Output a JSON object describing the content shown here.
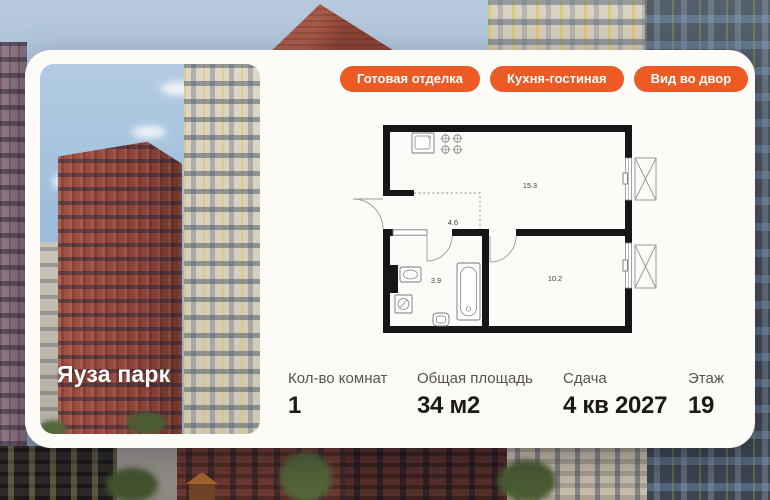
{
  "card": {
    "badges": [
      {
        "label": "Готовая отделка"
      },
      {
        "label": "Кухня-гостиная"
      },
      {
        "label": "Вид во двор"
      }
    ],
    "photo": {
      "project_name": "Яуза парк"
    },
    "floorplan": {
      "areas": {
        "kitchen_living": "15.3",
        "hallway": "4.6",
        "bathroom": "3.9",
        "bedroom": "10.2"
      }
    },
    "stats": [
      {
        "label": "Кол-во комнат",
        "value": "1"
      },
      {
        "label": "Общая площадь",
        "value": "34 м2"
      },
      {
        "label": "Сдача",
        "value": "4 кв 2027"
      },
      {
        "label": "Этаж",
        "value": "19"
      }
    ]
  },
  "colors": {
    "accent_orange": "#ee5a24",
    "card_bg": "#fcfbf8",
    "plan_wall": "#161616"
  }
}
